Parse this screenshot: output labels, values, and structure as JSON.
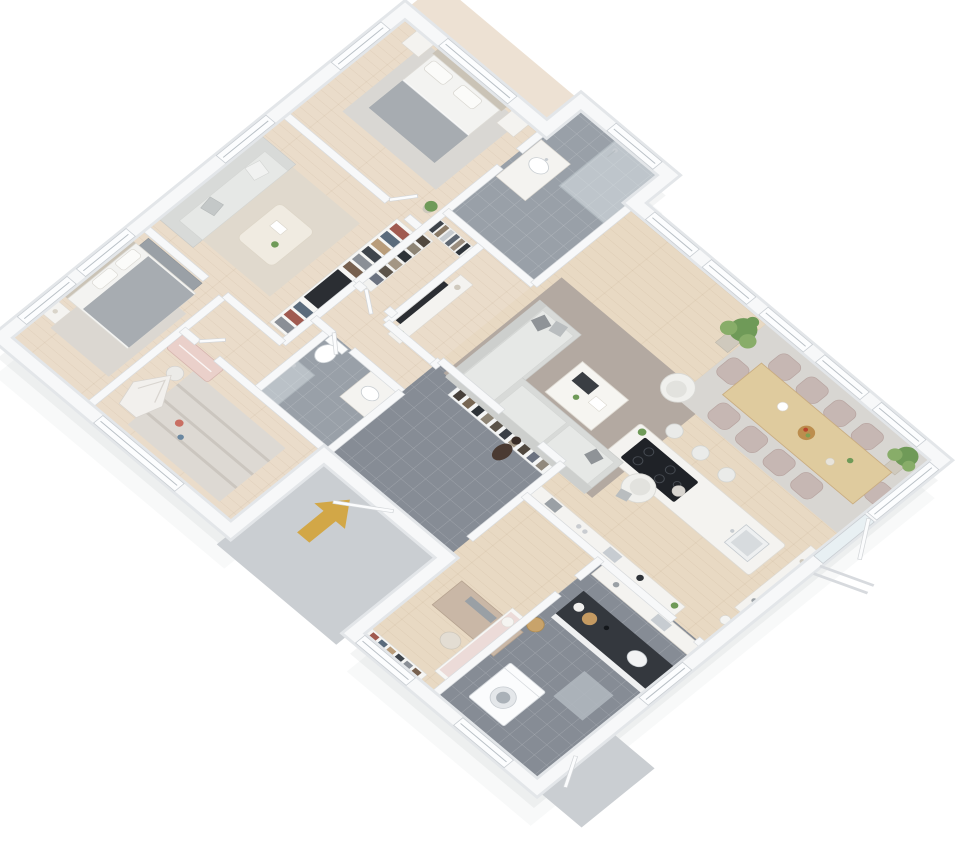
{
  "scene": {
    "type": "3d-isometric-floorplan-render",
    "description": "Photoreal dollhouse-style 3D floor plan of a large single-storey home, white walls on white background, viewed from above at an angle",
    "background": "#ffffff",
    "projection": "axonometric, plan rotated roughly 40 degrees"
  },
  "palette": {
    "wallFill": "#f7f8f9",
    "wallOuter": "#e3e6e9",
    "wallEdge": "#d9dcdf",
    "woodFloor": "#e8d9c3",
    "woodFloorWest": "#eadccb",
    "tileDark": "#868c95",
    "tileMid": "#99a0a8",
    "pavingLight": "#caced2",
    "rugLiving": "#b3a9a1",
    "rugDining": "#d8d6d2",
    "rugMaster": "#d9d7d3",
    "rugFamily": "#e0d9cd",
    "rugBedroom": "#dbd7d1",
    "rugKids": "#ddd9d3",
    "sofaGray": "#d8dad8",
    "sofaSeat": "#e6e8e6",
    "sofaShade": "#cdcfcd",
    "pillowDark": "#8f9397",
    "bedWhite": "#f3f3f1",
    "bedGray": "#a7acb1",
    "headboardTan": "#cac3b6",
    "furnitureWhite": "#f4f3f0",
    "tableWood": "#dfcb9e",
    "deskWood": "#c9b7a6",
    "chairBlush": "#c6b7b3",
    "stoolWhite": "#eaebe9",
    "counterDark": "#34383e",
    "cooktopBlack": "#1f2227",
    "steel": "#c7ccd1",
    "tvBlack": "#2b2e33",
    "plantGreen": "#6f9a58",
    "plantLightGreen": "#88ad69",
    "potBeige": "#cfc9bd",
    "arrowGold": "#d2a747",
    "personBrown": "#4a3a32",
    "kidsDeskPink": "#ead0ca",
    "basketTan": "#c8a36b",
    "glass": "#e3ebee"
  },
  "rooms": [
    {
      "id": "master-bedroom",
      "label": "Master bedroom",
      "floor": "light wood",
      "furniture": [
        "double bed with grey throw",
        "two nightstands",
        "grey rug",
        "potted plant"
      ]
    },
    {
      "id": "ensuite-bathroom",
      "label": "En-suite bathroom",
      "floor": "grey tile",
      "furniture": [
        "walk-in glass shower",
        "white vanity with basin"
      ]
    },
    {
      "id": "family-room",
      "label": "Family room",
      "floor": "light wood",
      "furniture": [
        "light grey sofa",
        "coffee table",
        "full-height bookshelf wall",
        "wall TV",
        "beige rug"
      ]
    },
    {
      "id": "walk-in-closet",
      "label": "Walk-in closet",
      "floor": "light wood",
      "furniture": [
        "hanging clothes rails"
      ]
    },
    {
      "id": "bedroom-2",
      "label": "Bedroom 2",
      "floor": "light wood",
      "furniture": [
        "bed with grey duvet",
        "nightstand",
        "wardrobe",
        "rug"
      ]
    },
    {
      "id": "kids-room",
      "label": "Kids room",
      "floor": "light wood",
      "furniture": [
        "pink wall desk",
        "chair",
        "play teepee",
        "striped rug",
        "toys"
      ]
    },
    {
      "id": "main-bathroom",
      "label": "Bathroom",
      "floor": "grey tile",
      "furniture": [
        "toilet",
        "shower",
        "vanity with basin"
      ]
    },
    {
      "id": "entrance-hall",
      "label": "Entrance hall",
      "floor": "grey tile",
      "furniture": [
        "open coat rack with coats",
        "standing person figure"
      ]
    },
    {
      "id": "great-room",
      "label": "Open plan living / dining / kitchen",
      "floor": "light wood",
      "furniture": [
        "corner sofa",
        "two white armchairs",
        "white coffee table",
        "TV console against closet wall",
        "dining table with ten blush chairs",
        "kitchen island with black hob and sink",
        "three bar stools",
        "kitchen counter run",
        "white sideboard",
        "two fiddle-leaf plants",
        "french door to garden"
      ]
    },
    {
      "id": "home-office",
      "label": "Home office",
      "floor": "light wood",
      "furniture": [
        "wooden desk",
        "chair",
        "low bookshelf",
        "daybed with ball cushion"
      ]
    },
    {
      "id": "utility-room",
      "label": "Utility / laundry",
      "floor": "grey tile",
      "furniture": [
        "dark worktop with sink and trays",
        "wall cabinets",
        "washing machine",
        "doormat",
        "laundry basket",
        "door to outside"
      ]
    }
  ],
  "annotations": {
    "entrance_arrow": {
      "meaning": "main entrance direction marker on exterior paving",
      "color": "#d2a747"
    },
    "person": {
      "meaning": "human scale figure standing near hallway"
    },
    "exterior_pads": [
      "entrance paving slab",
      "rear utility paving slab"
    ]
  }
}
